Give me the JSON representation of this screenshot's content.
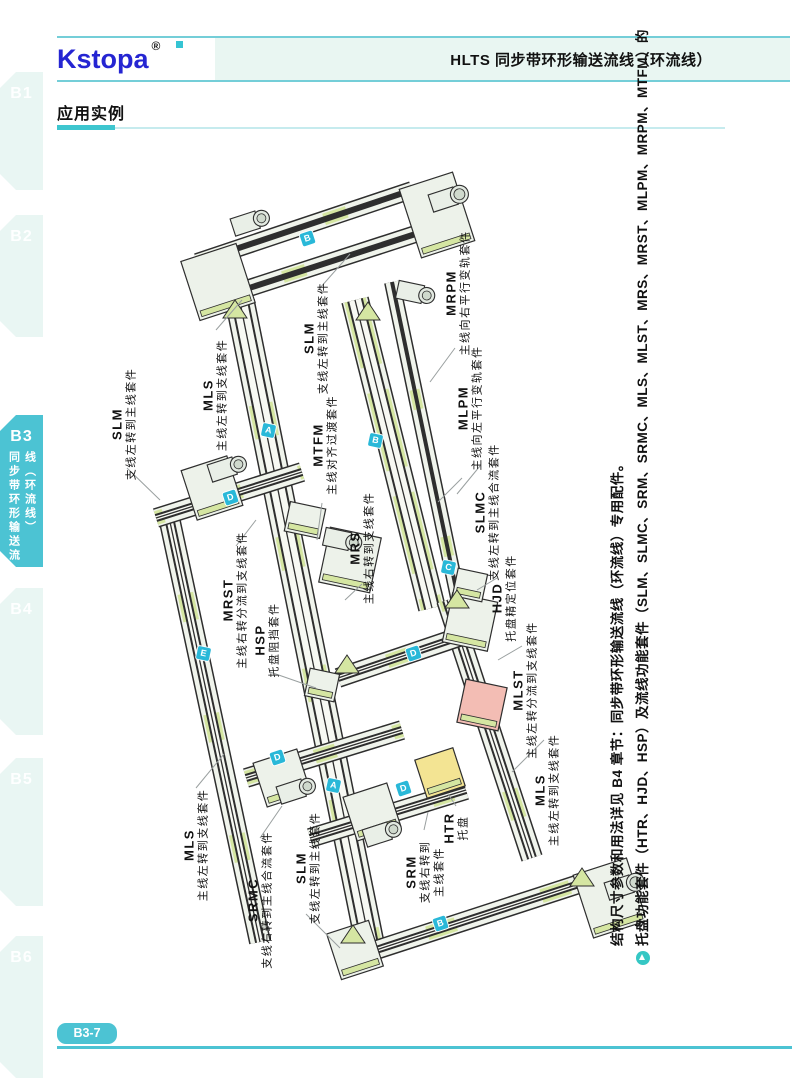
{
  "header": {
    "logo": "Kstopa",
    "registered": "®",
    "title": "HLTS 同步带环形输送流线（环流线）"
  },
  "sidebar": {
    "active_tab": "B3",
    "tabs": [
      {
        "label": "B1"
      },
      {
        "label": "B2"
      },
      {
        "label": "B3",
        "vertical": [
          "同步带环形输送流",
          "线（环流线）"
        ]
      },
      {
        "label": "B4"
      },
      {
        "label": "B5"
      },
      {
        "label": "B6"
      }
    ]
  },
  "section": {
    "title": "应用实例"
  },
  "diagram": {
    "labels": [
      {
        "acronym": "MRPM",
        "desc": "主线向右平行变轨套件",
        "x": 458,
        "y": 293
      },
      {
        "acronym": "SLM",
        "desc": "支线左转到主线套件",
        "x": 316,
        "y": 338
      },
      {
        "acronym": "MLS",
        "desc": "主线左转到支线套件",
        "x": 215,
        "y": 395
      },
      {
        "acronym": "SLM",
        "desc": "支线左转到主线套件",
        "x": 124,
        "y": 424
      },
      {
        "acronym": "MTFM",
        "desc": "主线对齐过渡套件",
        "x": 325,
        "y": 445
      },
      {
        "acronym": "MLPM",
        "desc": "主线向左平行变轨套件",
        "x": 470,
        "y": 408
      },
      {
        "acronym": "SLMC",
        "desc": "支线左转到主线合流套件",
        "x": 487,
        "y": 512
      },
      {
        "acronym": "MRS",
        "desc": "主线右转到支线套件",
        "x": 362,
        "y": 548
      },
      {
        "acronym": "MRST",
        "desc": "主线右转分流到支线套件",
        "x": 235,
        "y": 600
      },
      {
        "acronym": "HSP",
        "desc": "托盘阻挡套件",
        "x": 267,
        "y": 640
      },
      {
        "acronym": "HJD",
        "desc": "托盘精定位套件",
        "x": 504,
        "y": 598
      },
      {
        "acronym": "MLST",
        "desc": "主线左转分流到支线套件",
        "x": 525,
        "y": 690
      },
      {
        "acronym": "MLS",
        "desc": "主线左转到支线套件",
        "x": 547,
        "y": 790
      },
      {
        "acronym": "MLS",
        "desc": "主线左转到支线套件",
        "x": 196,
        "y": 845
      },
      {
        "acronym": "SRMC",
        "desc": "支线右转到主线合流套件",
        "x": 260,
        "y": 900
      },
      {
        "acronym": "SLM",
        "desc": "支线左转到主线套件",
        "x": 308,
        "y": 868
      },
      {
        "acronym": "SRM",
        "desc": "支线右转到\n主线套件",
        "x": 425,
        "y": 872
      },
      {
        "acronym": "HTR",
        "desc": "托盘",
        "x": 456,
        "y": 828
      }
    ],
    "badges": [
      {
        "letter": "B",
        "x": 307,
        "y": 238,
        "rot": -18
      },
      {
        "letter": "A",
        "x": 268,
        "y": 430,
        "rot": 12
      },
      {
        "letter": "B",
        "x": 375,
        "y": 440,
        "rot": 12
      },
      {
        "letter": "D",
        "x": 230,
        "y": 497,
        "rot": -18
      },
      {
        "letter": "C",
        "x": 448,
        "y": 567,
        "rot": 12
      },
      {
        "letter": "E",
        "x": 203,
        "y": 653,
        "rot": 12
      },
      {
        "letter": "D",
        "x": 413,
        "y": 653,
        "rot": -18
      },
      {
        "letter": "D",
        "x": 277,
        "y": 757,
        "rot": -18
      },
      {
        "letter": "A",
        "x": 333,
        "y": 785,
        "rot": 12
      },
      {
        "letter": "D",
        "x": 403,
        "y": 788,
        "rot": -18
      },
      {
        "letter": "B",
        "x": 440,
        "y": 923,
        "rot": -18
      }
    ],
    "note": {
      "line1": "托盘功能套件（HTR、HJD、HSP）及流线功能套件（SLM、SLMC、SRM、SRMC、MLS、MLST、MRS、MRST、MLPM、MRPM、MTFM）的",
      "line2": "结构尺寸参数和用法详见 B4 章节：同步带环形输送流线（环流线）专用配件。"
    }
  },
  "footer": {
    "page": "B3-7"
  },
  "colors": {
    "accent": "#47c2d1",
    "badge": "#29b8d8",
    "diagram_green": "#d5e6a2",
    "pallet_yellow": "#f3e493",
    "part_pink": "#f3bdb4",
    "logo_blue": "#2525d2"
  }
}
